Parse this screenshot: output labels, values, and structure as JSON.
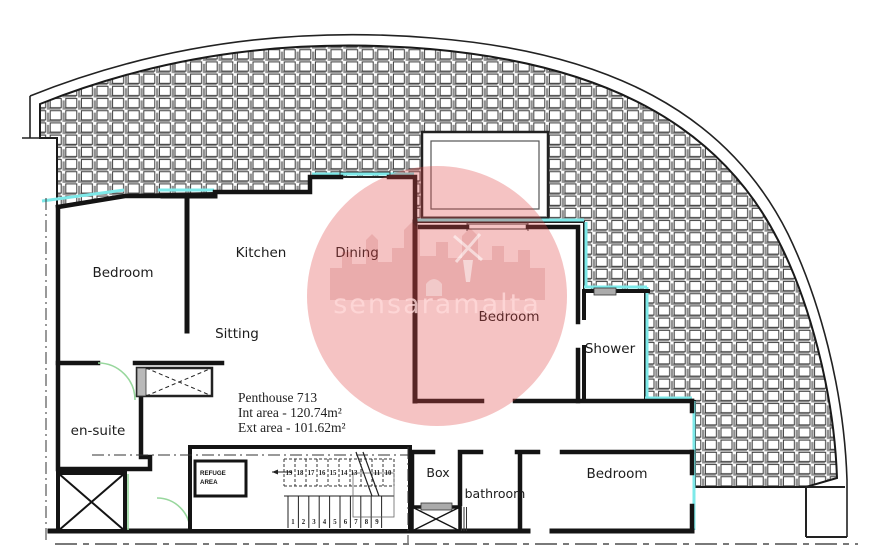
{
  "info": {
    "title": "Penthouse 713",
    "int_area": "Int area - 120.74m²",
    "ext_area": "Ext area - 101.62m²"
  },
  "rooms": {
    "bedroom_left": "Bedroom",
    "kitchen": "Kitchen",
    "dining": "Dining",
    "sitting": "Sitting",
    "bedroom_center": "Bedroom",
    "shower": "Shower",
    "ensuite": "en-suite",
    "box": "Box",
    "bathroom": "bathroom",
    "bedroom_right": "Bedroom"
  },
  "refuge": {
    "line1": "REFUGE",
    "line2": "AREA"
  },
  "stairs": {
    "upper": [
      "19",
      "18",
      "17",
      "16",
      "15",
      "14",
      "13",
      "11",
      "10"
    ],
    "lower": [
      "1",
      "2",
      "3",
      "4",
      "5",
      "6",
      "7",
      "8",
      "9"
    ]
  },
  "watermark": {
    "text": "sensaramalta"
  },
  "colors": {
    "window": "#7de9e9",
    "door_swing": "#98d79d",
    "wall": "#141414",
    "watermark_fill": "#e04a4a",
    "watermark_text": "#ffd9d9",
    "hatch_gray": "#8f8f8f"
  }
}
